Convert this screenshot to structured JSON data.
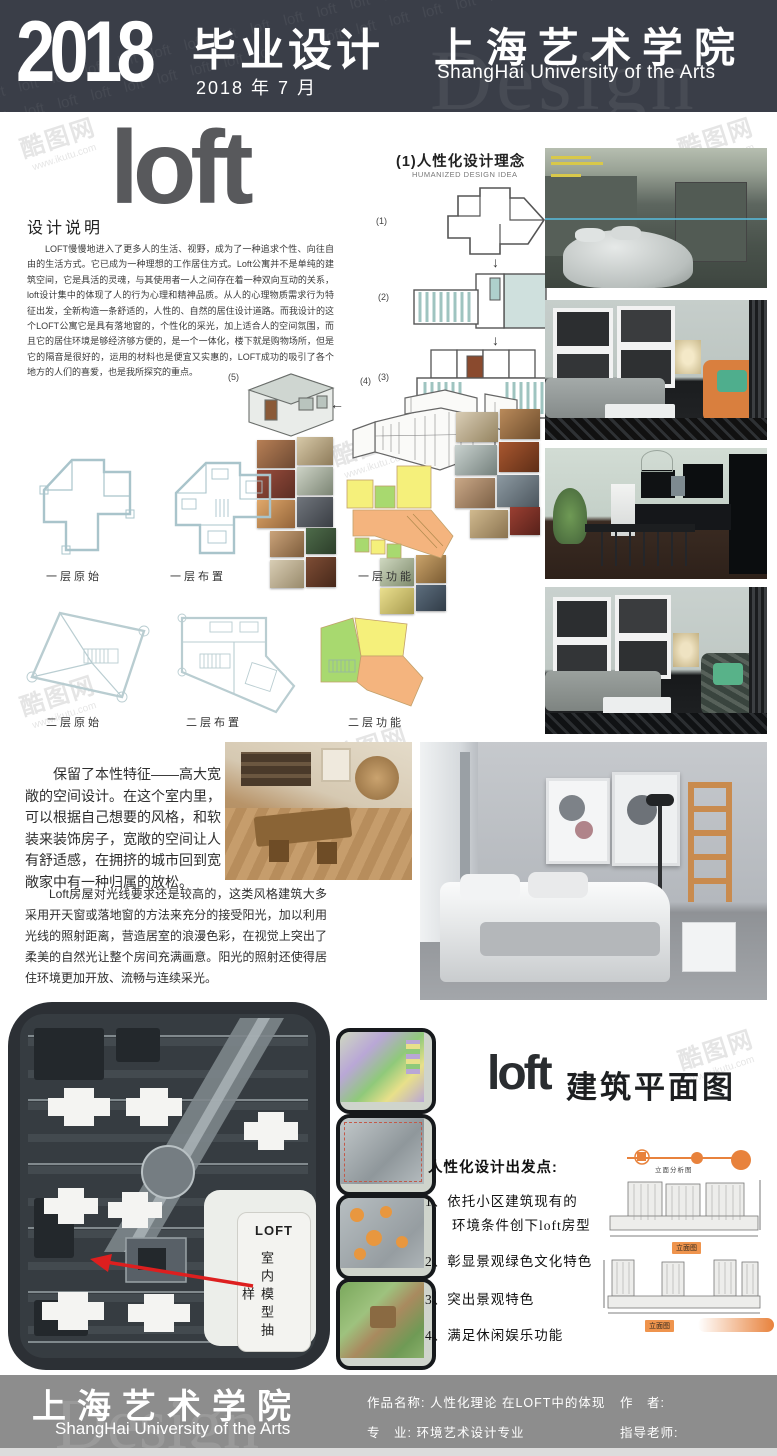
{
  "header": {
    "year": "2018",
    "program": "毕业设计",
    "date": "2018 年 7 月",
    "school_cn": "上海艺术学院",
    "school_en": "ShangHai University of the Arts",
    "bg_watermark": "Design",
    "loft_texture": "loft loft loft loft loft loft loft loft loft loft loft loft loft loft loft loft loft loft loft loft loft loft loft loft loft loft loft loft loft loft loft loft loft loft loft loft loft loft loft loft loft loft loft loft loft loft loft loft loft loft loft loft loft loft loft loft"
  },
  "logo": {
    "text": "loft"
  },
  "design_note": {
    "heading": "设计说明",
    "body": "LOFT慢慢地进入了更多人的生活、视野，成为了一种追求个性、向往自由的生活方式。它已成为一种理想的工作居住方式。Loft公寓并不是单纯的建筑空间，它是具活的灵魂，与其使用者一人之间存在着一种双向互动的关系，loft设计集中的体现了人的行为心理和精神品质。从人的心理物质需求行为特征出发，全新构造一条舒适的，人性的、自然的居住设计道路。而我设计的这个LOFT公寓它是具有落地窗的，个性化的采光，加上适合人的空间氛围，而且它的居住环境是够经济够方便的，是一个一体化，楼下就是购物场所，但是它的隔音是很好的，运用的材料也是便宜又实惠的，LOFT成功的吸引了各个地方的人们的喜爱，也是我所探究的重点。"
  },
  "concept": {
    "title": "(1)人性化设计理念",
    "subtitle": "HUMANIZED DESIGN IDEA",
    "step_labels": [
      "(1)",
      "(2)",
      "(3)",
      "(4)",
      "(5)"
    ],
    "arrow_down": "↓",
    "arrow_left": "←"
  },
  "plans": {
    "row1_labels": [
      "一层原始",
      "一层布置",
      "一层功能"
    ],
    "row2_labels": [
      "二层原始",
      "二层布置",
      "二层功能"
    ]
  },
  "narrative": {
    "p1": "保留了本性特征——高大宽敞的空间设计。在这个室内里，可以根据自己想要的风格，和软装来装饰房子，宽敞的空间让人有舒适感，在拥挤的城市回到宽敞家中有一种归属的放松。",
    "p2": "Loft房屋对光线要求还是较高的，这类风格建筑大多采用开天窗或落地窗的方法来充分的接受阳光，加以利用光线的照射距离，营造居室的浪漫色彩，在视觉上突出了柔美的自然光让整个房间充满画意。阳光的照射还使得居住环境更加开放、流畅与连续采光。"
  },
  "siteplan": {
    "callout_title": "LOFT",
    "callout_text": "室内模型抽样"
  },
  "floorplan_section": {
    "logo": "loft",
    "title": "建筑平面图"
  },
  "principles": {
    "heading": "人性化设计出发点:",
    "item1_line1": "1、依托小区建筑现有的",
    "item1_line2": "环境条件创下loft房型",
    "item2": "2、彰显景观绿色文化特色",
    "item3": "3、突出景观特色",
    "item4": "4、满足休闲娱乐功能"
  },
  "elevations": {
    "analysis_label": "立面分析图",
    "label1": "立面图",
    "label2": "立面图"
  },
  "footer": {
    "school_cn": "上海艺术学院",
    "school_en": "ShangHai University of the Arts",
    "work_label": "作品名称:",
    "work_value": "人性化理论 在LOFT中的体现",
    "major_label": "专　业:",
    "major_value": "环境艺术设计专业",
    "author_label": "作　者:",
    "advisor_label": "指导老师:",
    "bg_watermark": "Design"
  },
  "watermark": {
    "brand": "酷图网",
    "url": "www.ikutu.com"
  },
  "colors": {
    "header_bg": "#3a3e48",
    "footer_bg": "#8d8d8d",
    "accent_orange": "#e8823c",
    "arrow_red": "#dd1f1f",
    "plan_line": "#a9c4cb",
    "zone_yellow": "#f5f07b",
    "zone_green": "#a8d96f",
    "zone_orange": "#f4b47e",
    "logo_gray": "#58595c"
  }
}
